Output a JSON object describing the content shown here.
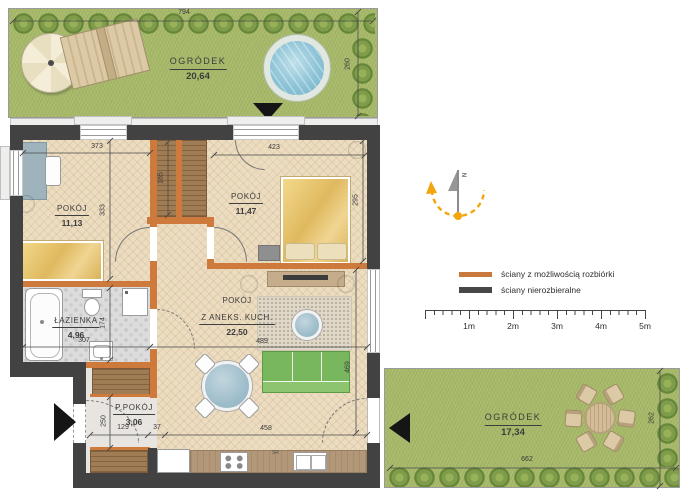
{
  "canvas": {
    "width": 682,
    "height": 500
  },
  "gardens": {
    "top": {
      "name": "OGRÓDEK",
      "area": "20,64",
      "width_cm": "794",
      "height_cm": "260"
    },
    "bottom": {
      "name": "OGRÓDEK",
      "area": "17,34",
      "width_cm": "662",
      "height_cm": "262"
    }
  },
  "rooms": {
    "room1": {
      "name": "POKÓJ",
      "area": "11,13",
      "width_cm": "373",
      "height_cm": "333"
    },
    "room2": {
      "name": "POKÓJ",
      "area": "11,47",
      "width_cm": "423",
      "height_cm": "295"
    },
    "bathroom": {
      "name": "ŁAZIENKA",
      "area": "4,96",
      "width_cm": "307",
      "height_cm": "174"
    },
    "living": {
      "name_line1": "POKÓJ",
      "name_line2": "Z ANEKS. KUCH.",
      "area": "22,50",
      "width_cm": "489",
      "bottom_width_cm": "458",
      "height_cm": "469"
    },
    "hall": {
      "name": "P.POKÓJ",
      "area": "3,06",
      "height_cm": "250",
      "width_cm": "129",
      "wall_stub_cm": "37"
    },
    "wardrobe_depth_cm": "185"
  },
  "kitchen": {
    "appliance_label": "SR"
  },
  "legend": {
    "removable": {
      "label": "ściany z możliwością rozbiórki",
      "color": "#c9793b"
    },
    "fixed": {
      "label": "ściany nierozbieralne",
      "color": "#474747"
    }
  },
  "scalebar": {
    "labels": [
      "1m",
      "2m",
      "3m",
      "4m",
      "5m"
    ]
  },
  "compass": {
    "north_label": "N"
  },
  "colors": {
    "grass": "#a8ba6a",
    "parquet": "#ecdcc0",
    "wall_fixed": "#424242",
    "wall_removable": "#cd7a3c",
    "compass_accent": "#f2a50c"
  }
}
